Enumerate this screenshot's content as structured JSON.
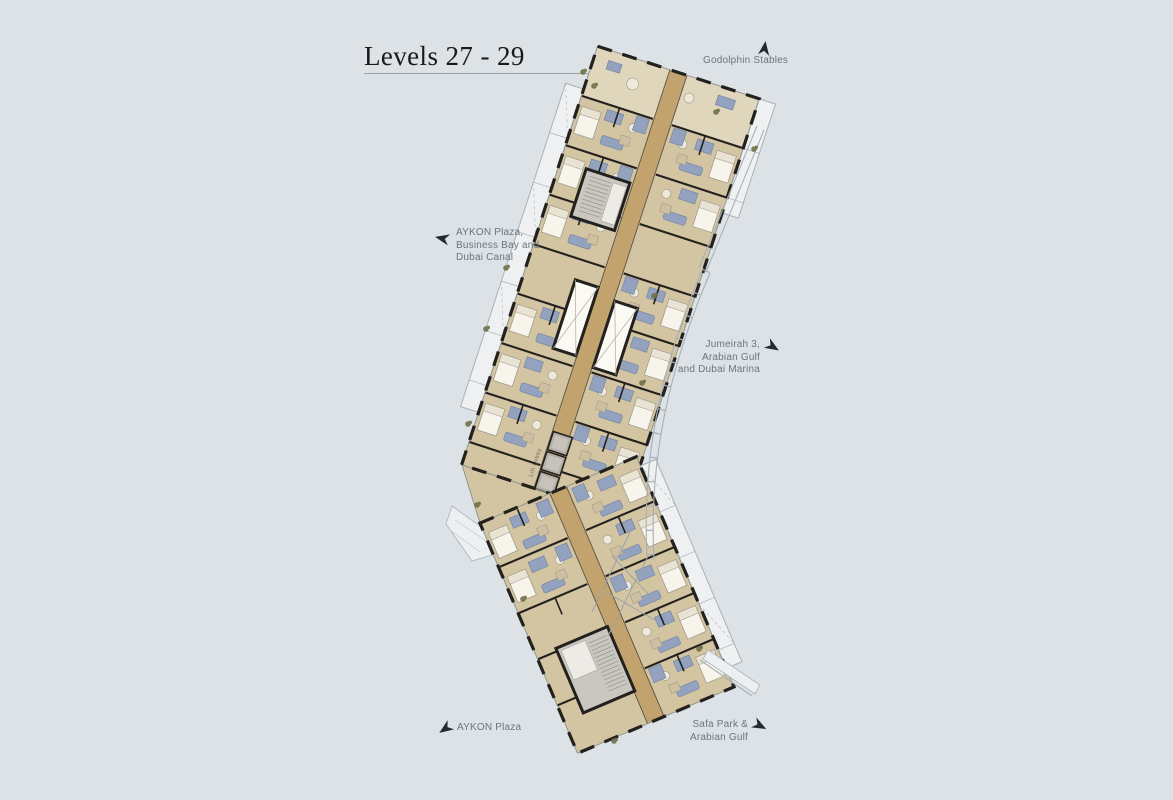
{
  "colors": {
    "bg": "#dde2e6",
    "floor": "#d3c4a2",
    "floor-light": "#e0d6bc",
    "corridor": "#c2a36d",
    "furniture": "#92a2bf",
    "furniture-dark": "#6f7fa0",
    "wall": "#23211e",
    "core": "#faf9f4",
    "lift": "#b5b1a8",
    "stair": "#cac7c1",
    "label": "#6a7582",
    "arrow": "#222a35",
    "title": "#17191c",
    "rule": "#9aa1a8",
    "balcony-line": "#a9b1b8",
    "plant": "#6f7048"
  },
  "title": {
    "text": "Levels 27 - 29"
  },
  "plan": {
    "lift_lobby_label": "Lift Lobby"
  },
  "labels": {
    "godolphin": {
      "line1": "Godolphin Stables"
    },
    "aykon_full": {
      "line1": "AYKON Plaza,",
      "line2": "Business Bay and",
      "line3": "Dubai Canal"
    },
    "jumeirah": {
      "line1": "Jumeirah 3,",
      "line2": "Arabian Gulf",
      "line3": "and Dubai Marina"
    },
    "aykon": {
      "line1": "AYKON Plaza"
    },
    "safa": {
      "line1": "Safa Park &",
      "line2": "Arabian Gulf"
    }
  }
}
